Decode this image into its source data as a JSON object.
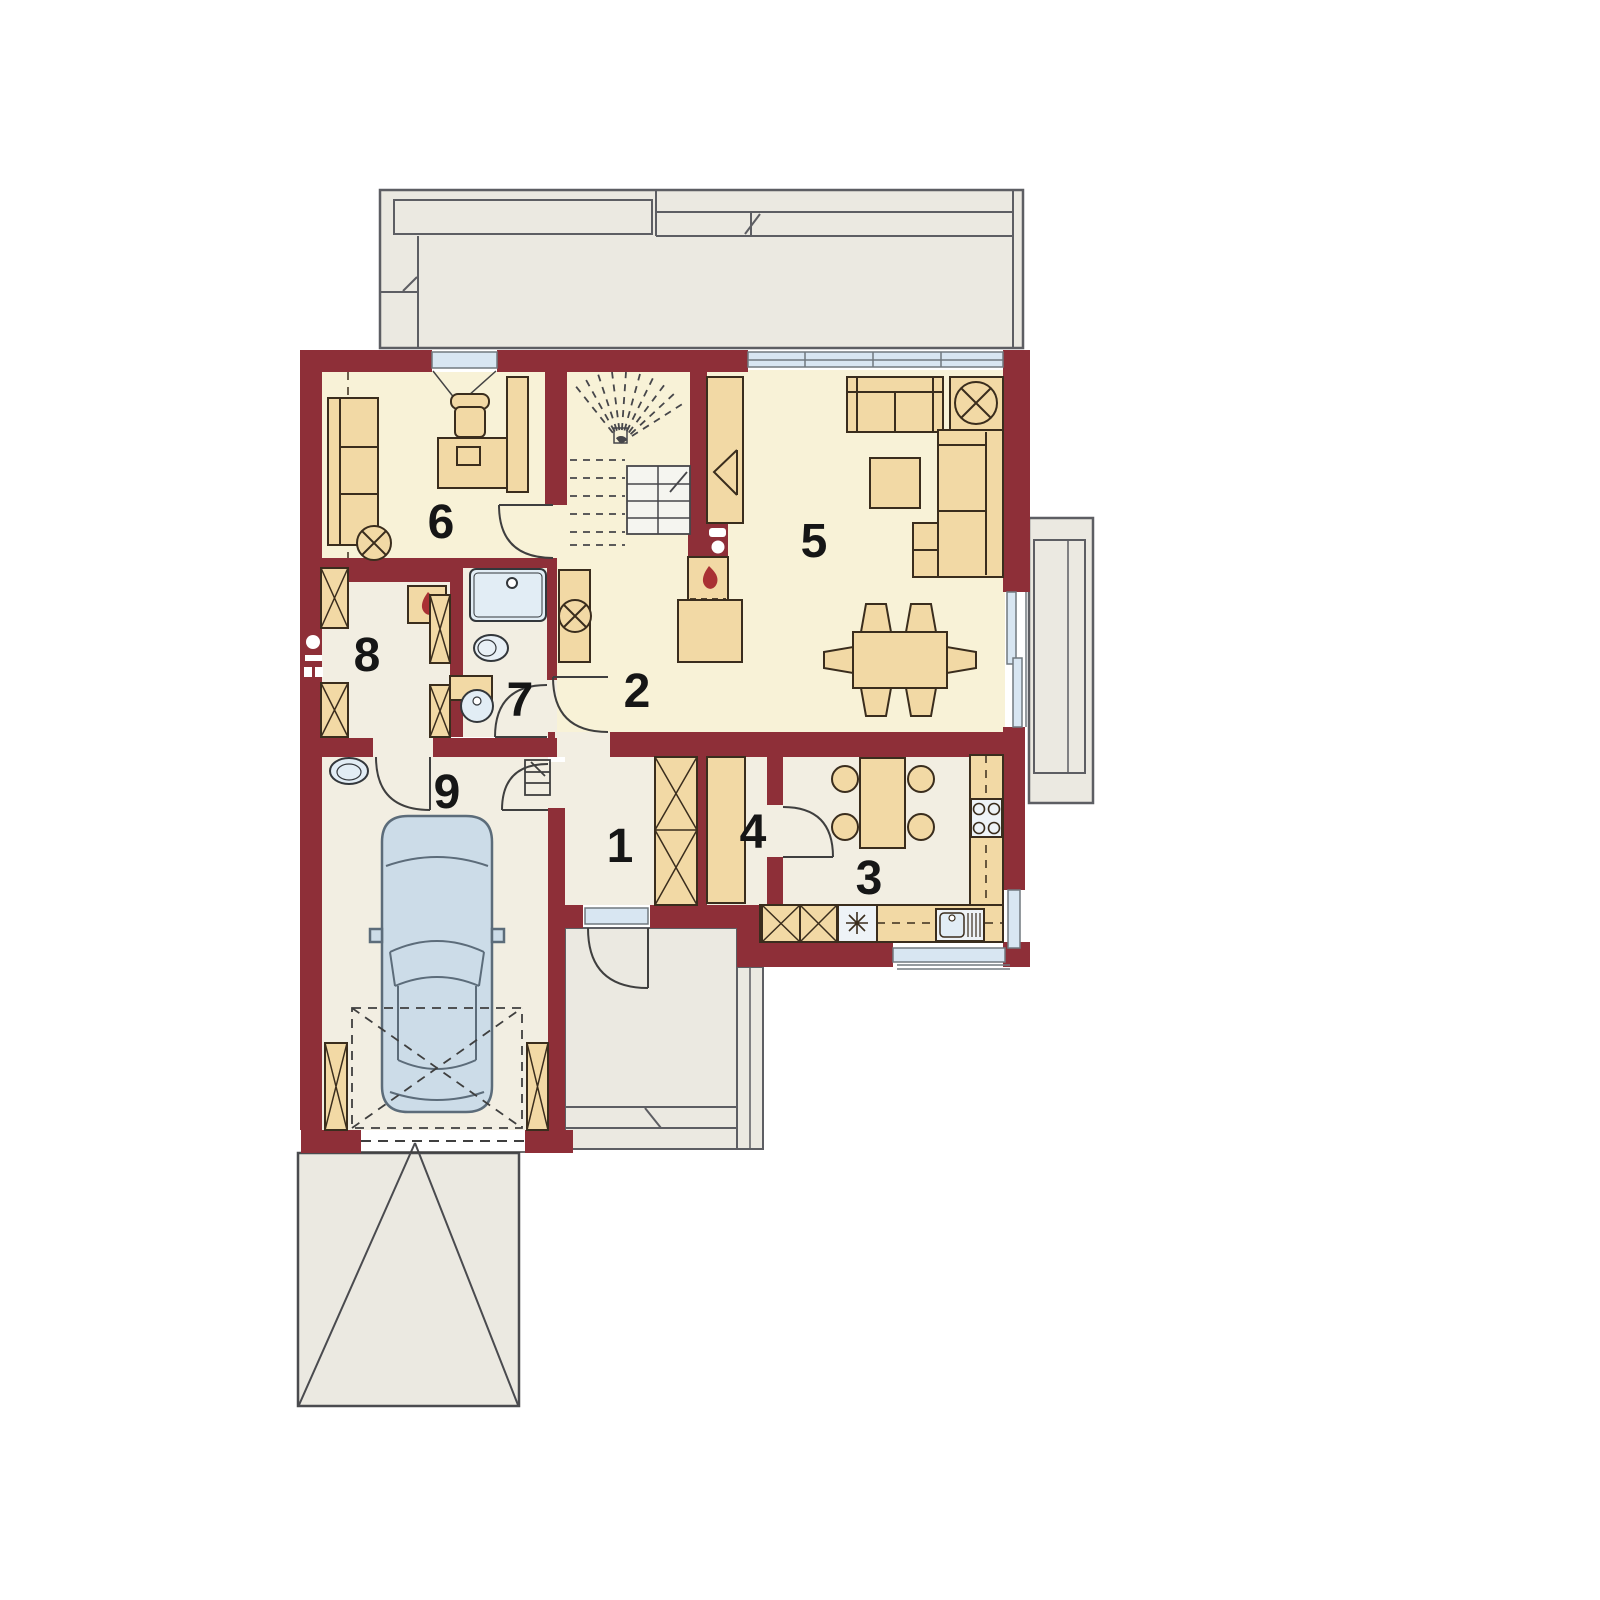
{
  "plan": {
    "type": "house-ground-floor-plan",
    "rooms": [
      {
        "label": "1",
        "name": "entry-hall"
      },
      {
        "label": "2",
        "name": "hall"
      },
      {
        "label": "3",
        "name": "kitchen"
      },
      {
        "label": "4",
        "name": "pantry"
      },
      {
        "label": "5",
        "name": "living-room"
      },
      {
        "label": "6",
        "name": "office"
      },
      {
        "label": "7",
        "name": "bathroom"
      },
      {
        "label": "8",
        "name": "utility-room"
      },
      {
        "label": "9",
        "name": "garage"
      }
    ]
  },
  "palette": {
    "wall": "#8e2f38",
    "floor_warm": "#f8f2d7",
    "floor_light": "#f2eee2",
    "furniture": "#f2d9a5",
    "furniture_line": "#3a2d1d",
    "fixture_fill": "#e2edf5",
    "glass": "#d8e6f2",
    "outdoor_gray": "#ebe9e1",
    "outdoor_line": "#5d5e63",
    "flame_red": "#a93134",
    "car_fill": "#ccdce8",
    "label_color": "#161616"
  }
}
